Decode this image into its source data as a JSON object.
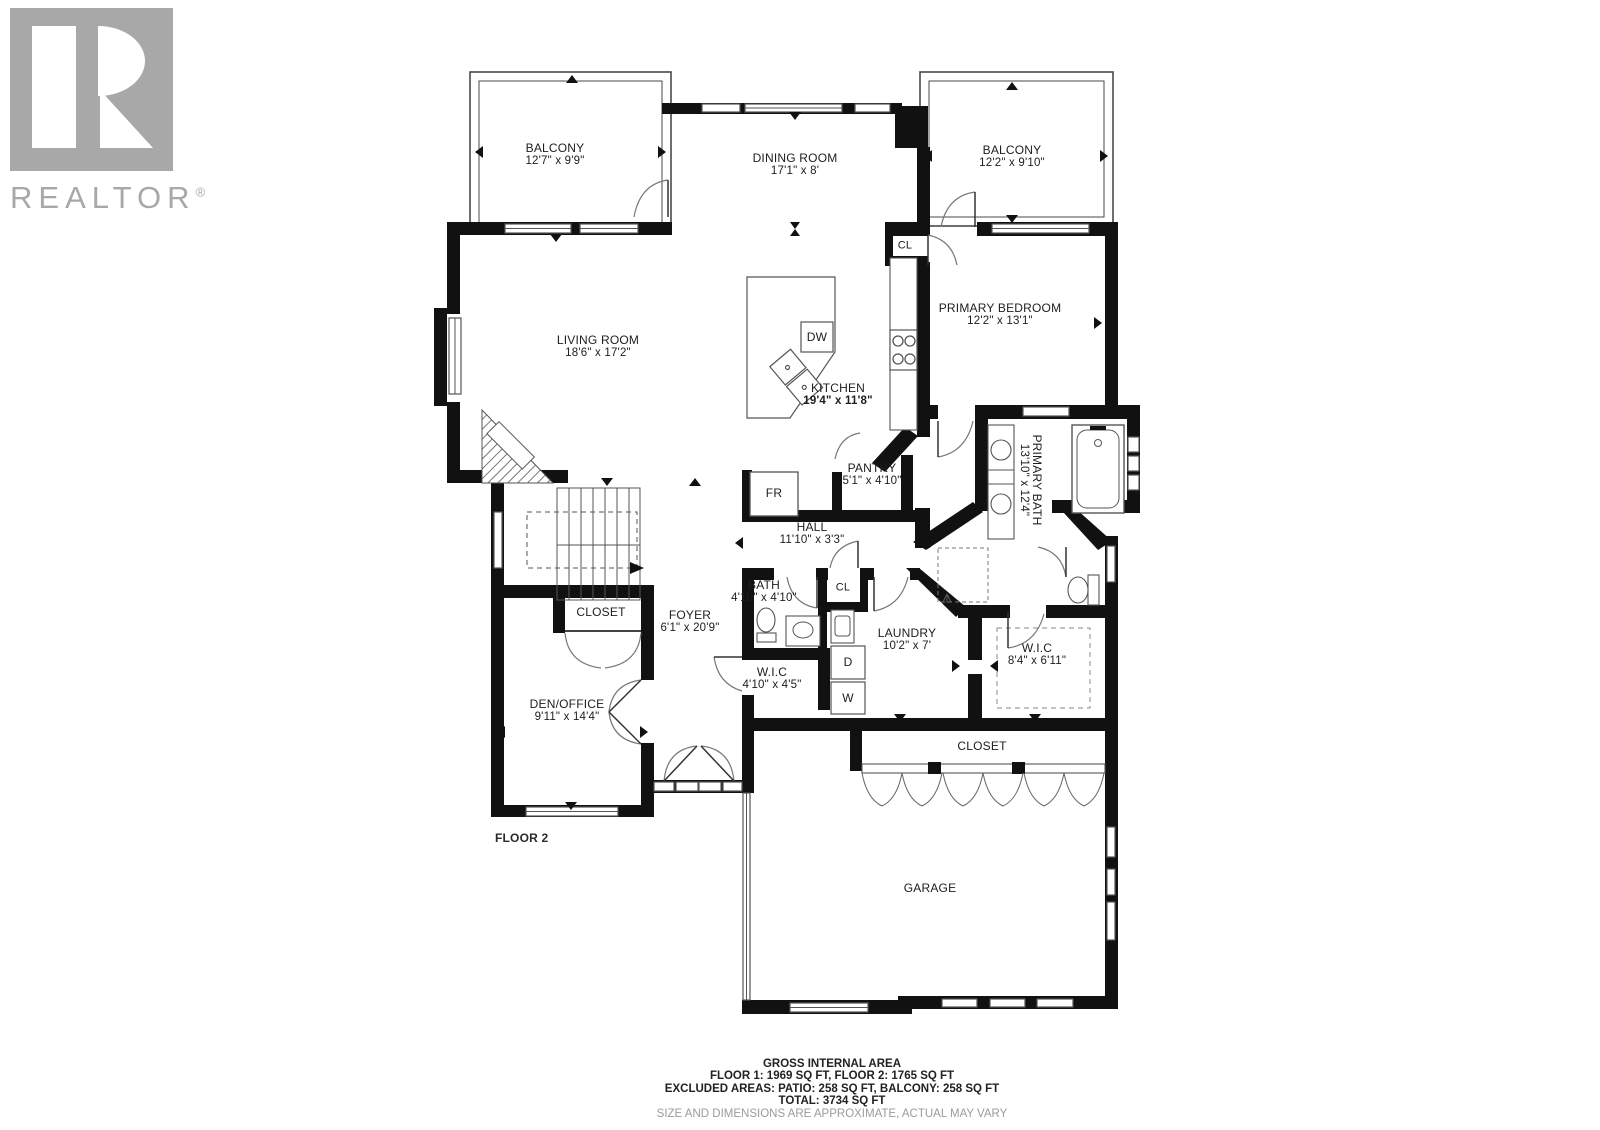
{
  "logo": {
    "brand": "REALTOR",
    "reg": "®"
  },
  "rooms": {
    "balcony1": {
      "name": "BALCONY",
      "dims": "12'7\" x 9'9\""
    },
    "dining": {
      "name": "DINING ROOM",
      "dims": "17'1\" x 8'"
    },
    "balcony2": {
      "name": "BALCONY",
      "dims": "12'2\" x 9'10\""
    },
    "primary_bedroom": {
      "name": "PRIMARY BEDROOM",
      "dims": "12'2\" x 13'1\""
    },
    "living": {
      "name": "LIVING ROOM",
      "dims": "18'6\" x 17'2\""
    },
    "kitchen": {
      "name": "KITCHEN",
      "dims": "19'4\" x 11'8\""
    },
    "pantry": {
      "name": "PANTRY",
      "dims": "5'1\" x 4'10\""
    },
    "hall": {
      "name": "HALL",
      "dims": "11'10\" x 3'3\""
    },
    "primary_bath": {
      "name": "PRIMARY BATH",
      "dims": "13'10\" x 12'4\""
    },
    "bath": {
      "name": "BATH",
      "dims": "4'10\" x 4'10\""
    },
    "laundry": {
      "name": "LAUNDRY",
      "dims": "10'2\" x 7'"
    },
    "wic_small": {
      "name": "W.I.C",
      "dims": "4'10\" x 4'5\""
    },
    "wic_large": {
      "name": "W.I.C",
      "dims": "8'4\" x 6'11\""
    },
    "den_office": {
      "name": "DEN/OFFICE",
      "dims": "9'11\" x 14'4\""
    },
    "foyer": {
      "name": "FOYER",
      "dims": "6'1\" x 20'9\""
    },
    "garage": {
      "name": "GARAGE"
    },
    "closet_den": {
      "name": "CLOSET"
    },
    "closet_garage": {
      "name": "CLOSET"
    },
    "cl_bedroom": {
      "name": "CL"
    },
    "cl_hall": {
      "name": "CL"
    }
  },
  "appliances": {
    "fridge": "FR",
    "dishwasher": "DW",
    "dryer": "D",
    "washer": "W"
  },
  "floor_label": "FLOOR 2",
  "summary": {
    "title": "GROSS INTERNAL AREA",
    "line1": "FLOOR 1: 1969 SQ FT, FLOOR 2: 1765 SQ FT",
    "line2": "EXCLUDED AREAS: PATIO: 258 SQ FT, BALCONY: 258 SQ FT",
    "line3": "TOTAL: 3734 SQ FT",
    "disclaimer": "SIZE AND DIMENSIONS ARE APPROXIMATE, ACTUAL MAY VARY"
  },
  "colors": {
    "wall": "#111111",
    "logo_gray": "#a8a8a8",
    "thin_line": "#555555",
    "disclaimer_gray": "#9b9b9b"
  }
}
